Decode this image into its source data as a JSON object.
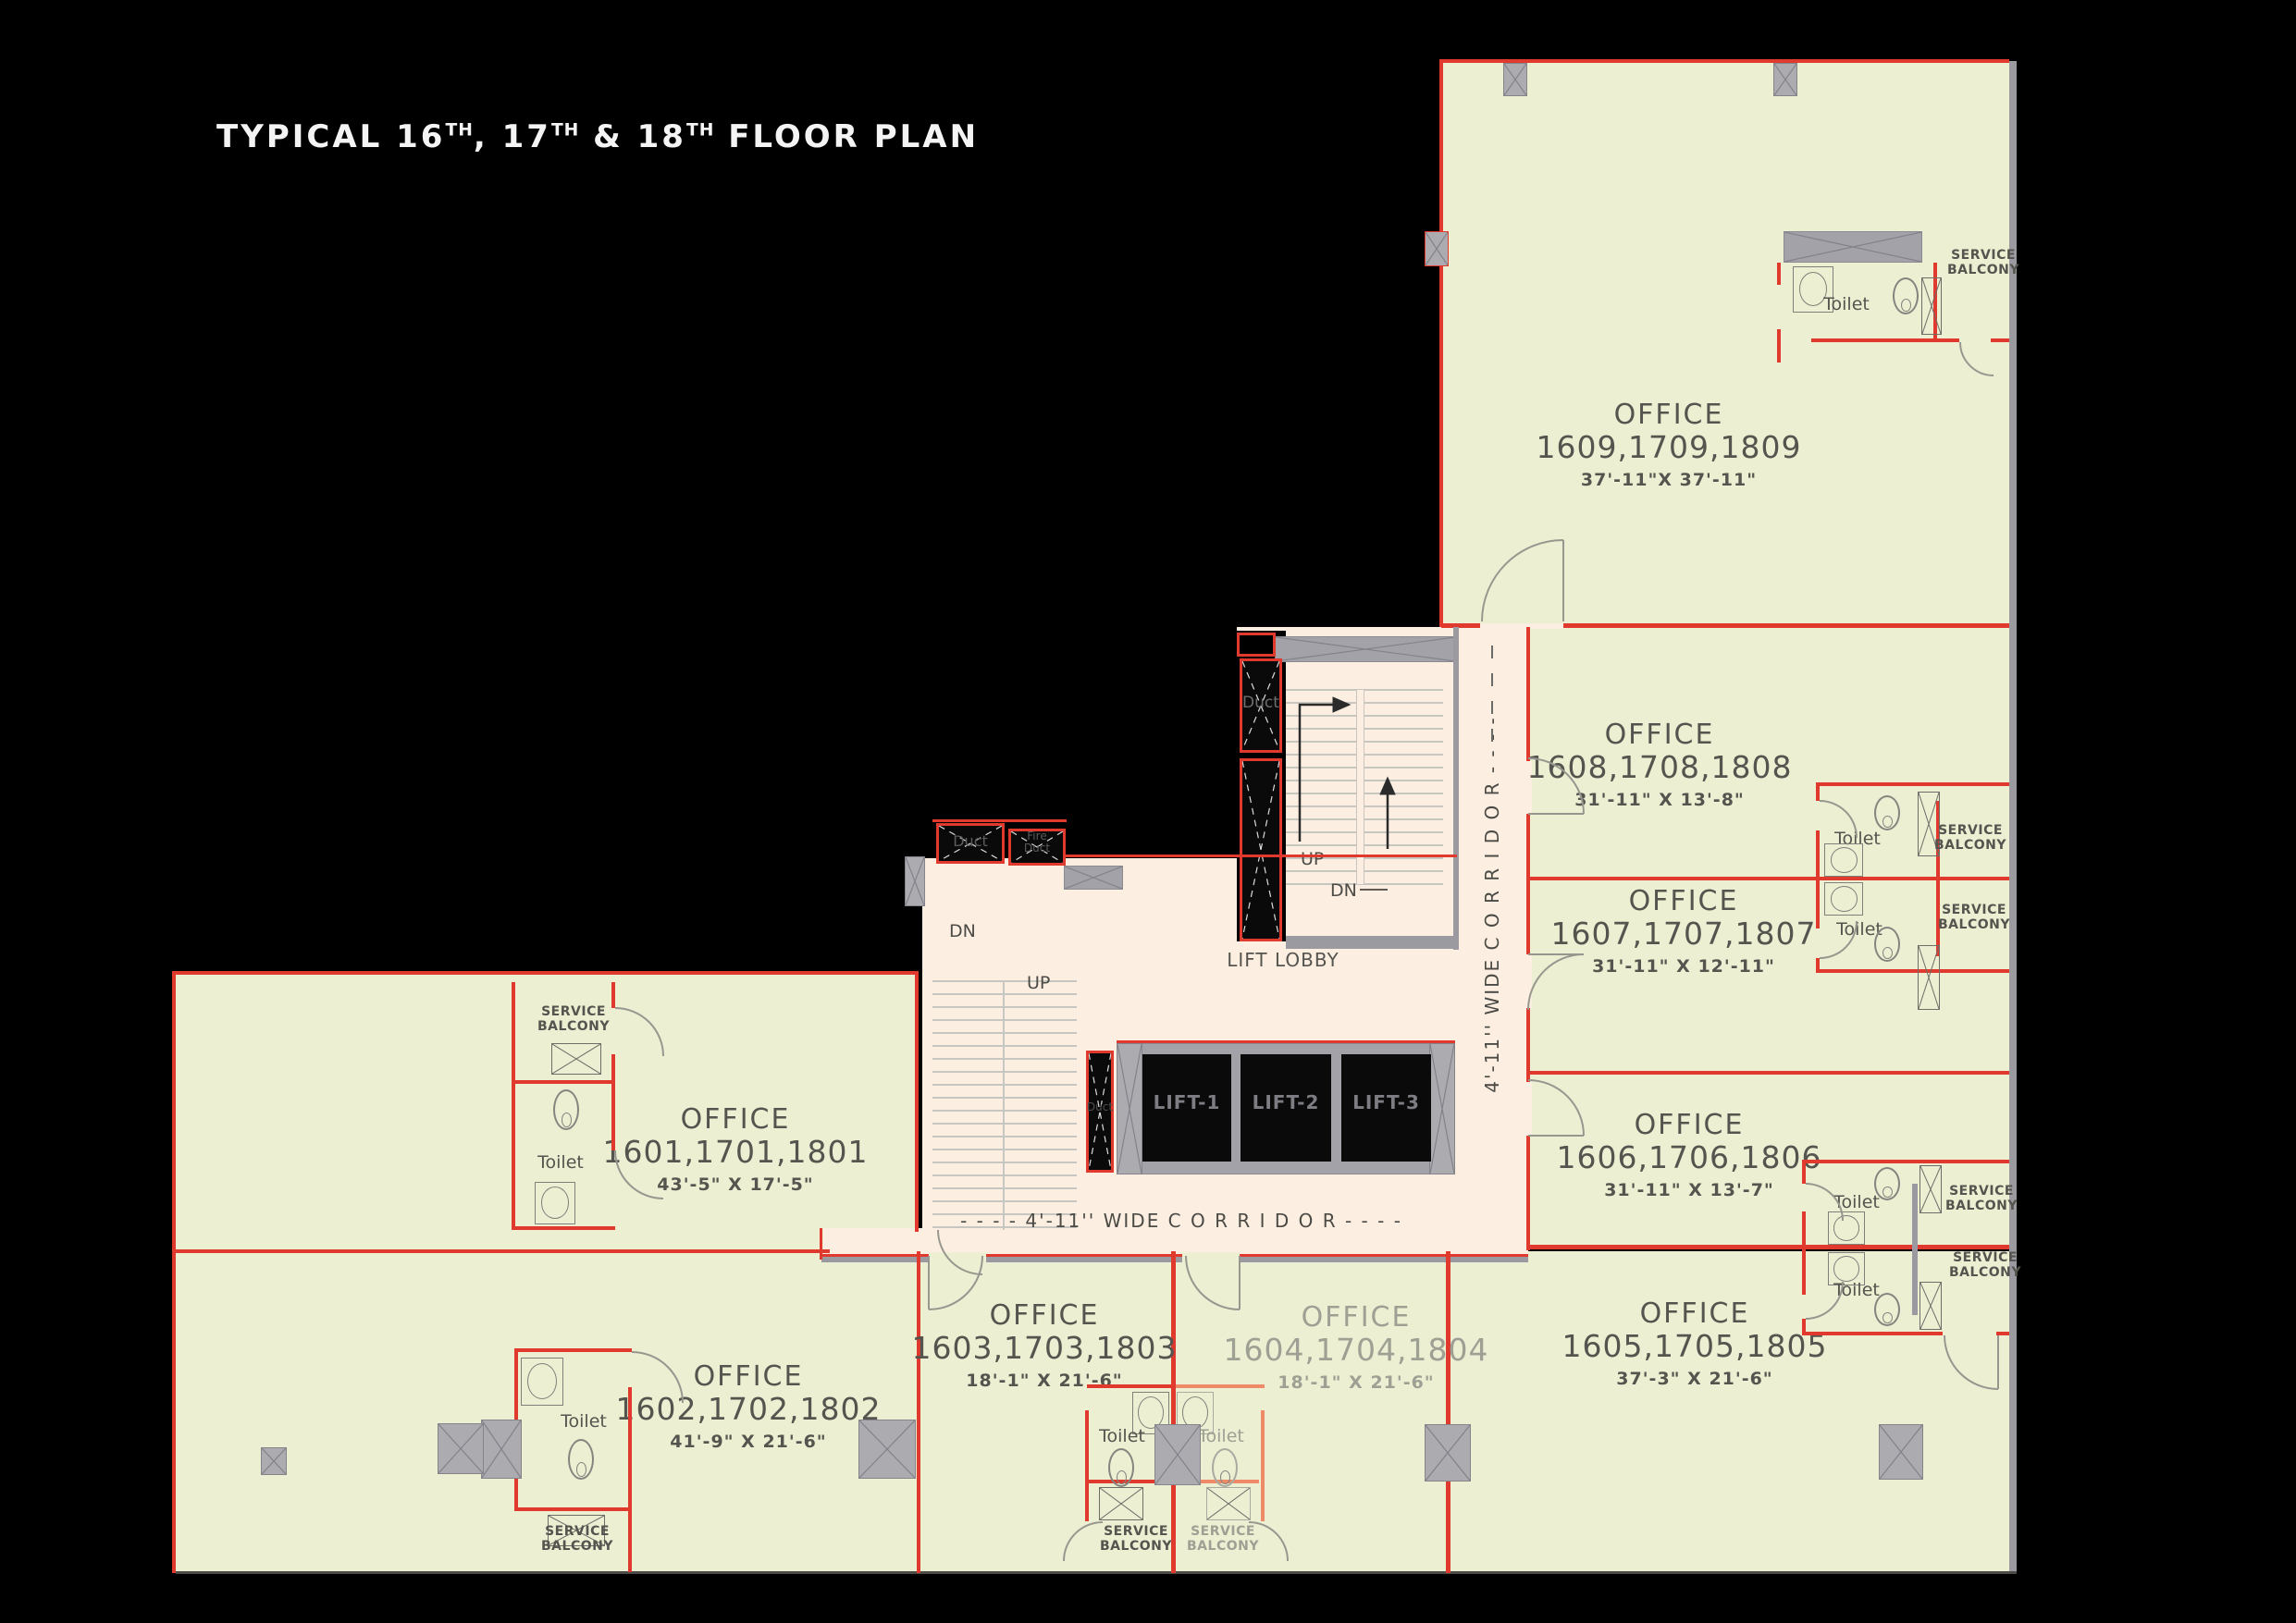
{
  "title": {
    "p1": "TYPICAL 16",
    "s1": "TH",
    "p2": ", 17",
    "s2": "TH",
    "p3": " & 18",
    "s3": "TH",
    "p4": " FLOOR PLAN"
  },
  "labels": {
    "office": "OFFICE",
    "toilet": "Toilet",
    "service": "SERVICE",
    "balcony": "BALCONY",
    "up": "UP",
    "dn": "DN",
    "duct": "Duct",
    "fire": "Fire",
    "lift_lobby": "LIFT  LOBBY"
  },
  "offices": {
    "o1601": {
      "numbers": "1601,1701,1801",
      "size": "43'-5\" X  17'-5\""
    },
    "o1602": {
      "numbers": "1602,1702,1802",
      "size": "41'-9\" X  21'-6\""
    },
    "o1603": {
      "numbers": "1603,1703,1803",
      "size": "18'-1\" X  21'-6\""
    },
    "o1604": {
      "numbers": "1604,1704,1804",
      "size": "18'-1\" X  21'-6\""
    },
    "o1605": {
      "numbers": "1605,1705,1805",
      "size": "37'-3\" X  21'-6\""
    },
    "o1606": {
      "numbers": "1606,1706,1806",
      "size": "31'-11\" X  13'-7\""
    },
    "o1607": {
      "numbers": "1607,1707,1807",
      "size": "31'-11\" X  12'-11\""
    },
    "o1608": {
      "numbers": "1608,1708,1808",
      "size": "31'-11\" X  13'-8\""
    },
    "o1609": {
      "numbers": "1609,1709,1809",
      "size": "37'-11\"X  37'-11\""
    }
  },
  "lifts": {
    "l1": "LIFT-1",
    "l2": "LIFT-2",
    "l3": "LIFT-3"
  },
  "corridors": {
    "vertical": "4'-11''  WIDE  C O R R I D O R  - - - -",
    "horizontal": "- - - -  4'-11''  WIDE  C O R R I D O R  - - - -"
  },
  "colors": {
    "room_fill": "#ecefd2",
    "corridor_fill": "#fcefe2",
    "wall_red": "#e0392e",
    "wall_gray": "#9b9aa0",
    "shaft": "#0a0a0a",
    "text_dark": "#55544e",
    "text_light": "#9fa094"
  }
}
